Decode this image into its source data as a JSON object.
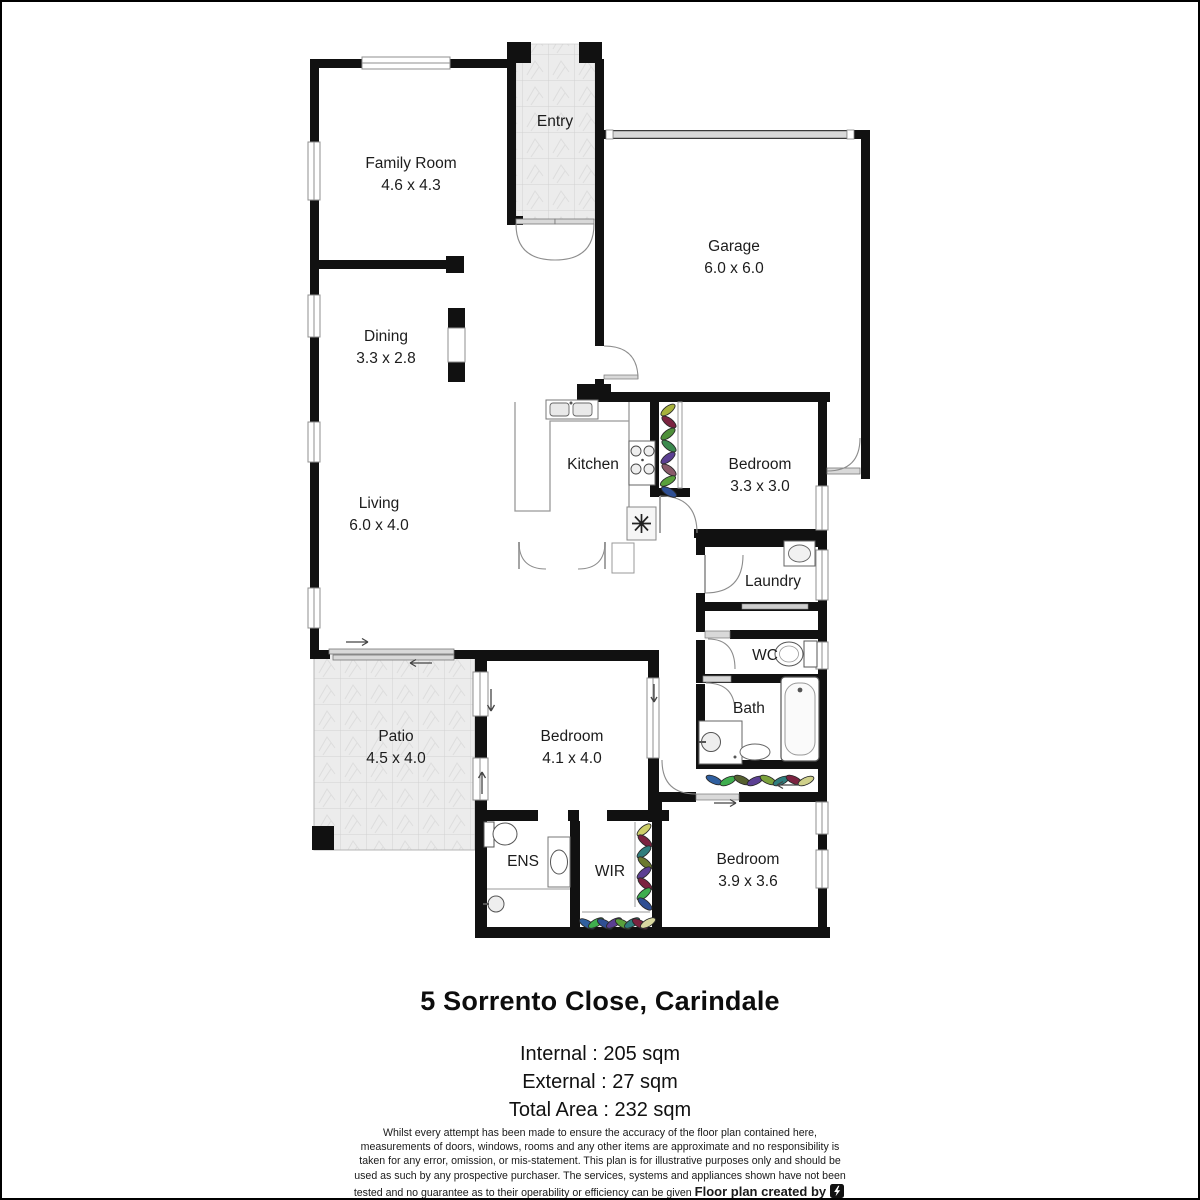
{
  "plan": {
    "rooms": [
      {
        "id": "family-room",
        "name": "Family Room",
        "dims": "4.6 x 4.3"
      },
      {
        "id": "entry",
        "name": "Entry",
        "dims": ""
      },
      {
        "id": "garage",
        "name": "Garage",
        "dims": "6.0 x 6.0"
      },
      {
        "id": "dining",
        "name": "Dining",
        "dims": "3.3 x 2.8"
      },
      {
        "id": "living",
        "name": "Living",
        "dims": "6.0 x 4.0"
      },
      {
        "id": "kitchen",
        "name": "Kitchen",
        "dims": ""
      },
      {
        "id": "bedroom-2",
        "name": "Bedroom",
        "dims": "3.3 x 3.0"
      },
      {
        "id": "laundry",
        "name": "Laundry",
        "dims": ""
      },
      {
        "id": "wc",
        "name": "WC",
        "dims": ""
      },
      {
        "id": "bath",
        "name": "Bath",
        "dims": ""
      },
      {
        "id": "patio",
        "name": "Patio",
        "dims": "4.5 x 4.0"
      },
      {
        "id": "bedroom-main",
        "name": "Bedroom",
        "dims": "4.1 x 4.0"
      },
      {
        "id": "ens",
        "name": "ENS",
        "dims": ""
      },
      {
        "id": "wir",
        "name": "WIR",
        "dims": ""
      },
      {
        "id": "bedroom-3",
        "name": "Bedroom",
        "dims": "3.9 x 3.6"
      }
    ]
  },
  "footer": {
    "title": "5 Sorrento Close, Carindale",
    "area_lines": [
      "Internal : 205 sqm",
      "External : 27 sqm",
      "Total Area : 232 sqm"
    ],
    "disclaimer": "Whilst every attempt has been made to ensure the accuracy of the floor plan contained here, measurements of doors, windows, rooms and any other items are approximate and no responsibility is taken for any error, omission, or mis-statement. This plan is for illustrative purposes only and should be used as such by any prospective purchaser. The services, systems and appliances shown have not been tested and no guarantee as to their operability or efficiency can be given",
    "credit": "Floor plan created by",
    "brand": {
      "part1": "Fast",
      "part2": "Focus",
      "part3": ".com.au"
    }
  },
  "colors": {
    "wall": "#111111",
    "window_line": "#8f8f8f",
    "door": "#8c8c8c",
    "door_leaf": "#d9d9d9",
    "tile": "#ececec"
  }
}
